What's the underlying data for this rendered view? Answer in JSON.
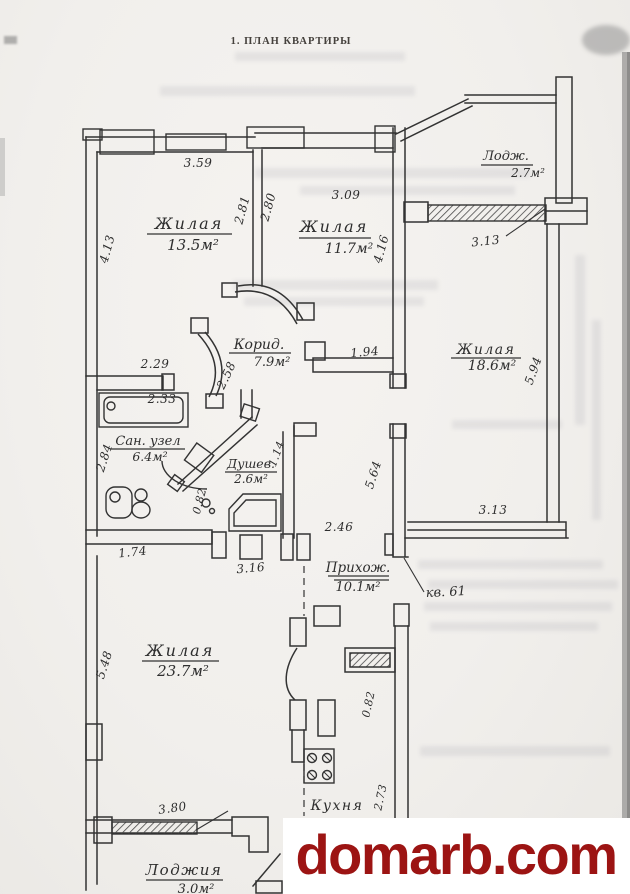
{
  "title": "1. ПЛАН КВАРТИРЫ",
  "watermark": {
    "text": "domarb.com",
    "color": "#9c1413"
  },
  "apartment_ref": "кв. 61",
  "ink_color": "#333333",
  "paper_color": "#f1efec",
  "rooms": {
    "living1": {
      "name": "Жилая",
      "area": "13.5м²"
    },
    "living2": {
      "name": "Жилая",
      "area": "11.7м²"
    },
    "loggia_top": {
      "name": "Лодж.",
      "area": "2.7м²"
    },
    "living3": {
      "name": "Жилая",
      "area": "18.6м²"
    },
    "corridor": {
      "name": "Корид.",
      "area": "7.9м²"
    },
    "bathroom": {
      "name": "Сан. узел",
      "area": "6.4м²"
    },
    "shower": {
      "name": "Душев.",
      "area": "2.6м²"
    },
    "hall": {
      "name": "Прихож.",
      "area": "10.1м²"
    },
    "living4": {
      "name": "Жилая",
      "area": "23.7м²"
    },
    "kitchen": {
      "name": "Кухня",
      "area": ""
    },
    "loggia_bottom": {
      "name": "Лоджия",
      "area": "3.0м²"
    }
  },
  "dims": {
    "d359": "3.59",
    "d413": "4.13",
    "d281": "2.81",
    "d280": "2.80",
    "d309": "3.09",
    "d416": "4.16",
    "d313a": "3.13",
    "d594": "5.94",
    "d229": "2.29",
    "d258": "2.58",
    "d194": "1.94",
    "d233": "2.33",
    "d284": "2.84",
    "d114": "1.14",
    "d082a": "0.82",
    "d564": "5.64",
    "d246": "2.46",
    "d313b": "3.13",
    "d174": "1.74",
    "d316": "3.16",
    "d548": "5.48",
    "d082b": "0.82",
    "d380": "3.80",
    "d273": "2.73"
  }
}
